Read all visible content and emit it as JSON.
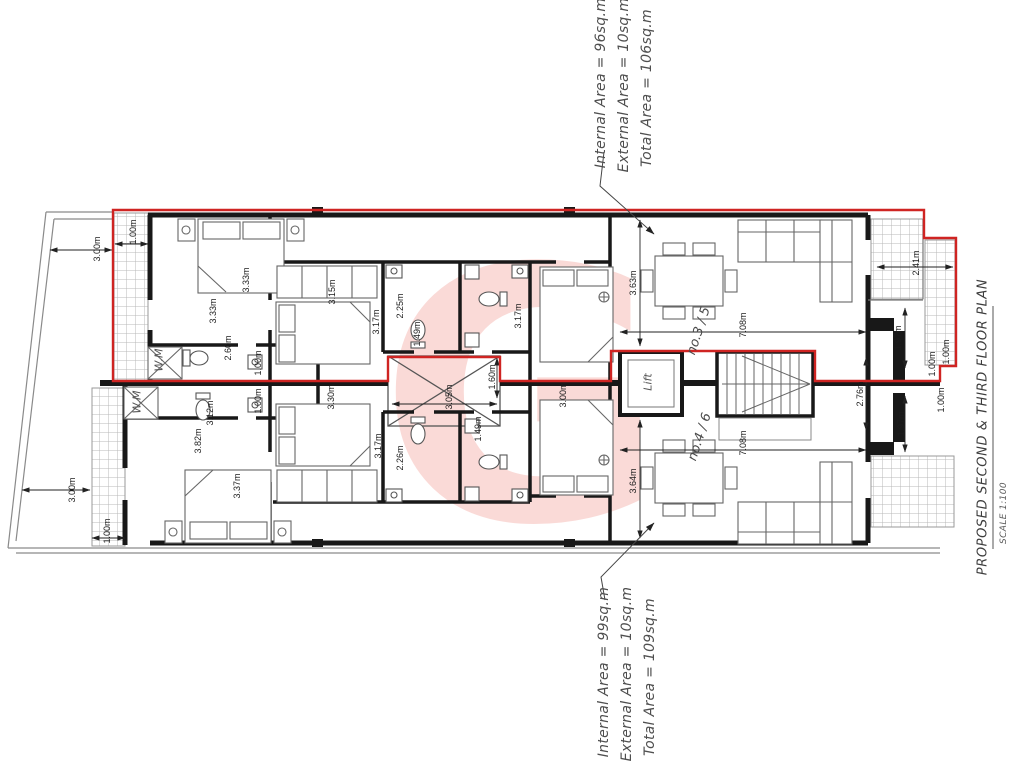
{
  "title_block": {
    "title": "PROPOSED SECOND & THIRD FLOOR PLAN",
    "scale": "SCALE 1:100"
  },
  "units": {
    "upper": {
      "unit_no": "no.3 / 5",
      "areas": [
        "Internal Area = 96sq.m",
        "External Area = 10sq.m",
        "Total Area = 106sq.m"
      ]
    },
    "lower": {
      "unit_no": "no.4 / 6",
      "areas": [
        "Internal Area = 99sq.m",
        "External Area = 10sq.m",
        "Total Area = 109sq.m"
      ]
    }
  },
  "room_labels": [
    {
      "text": "W.M",
      "x": 159,
      "y": 360
    },
    {
      "text": "W.M",
      "x": 137,
      "y": 402
    },
    {
      "text": "Lift",
      "x": 648,
      "y": 382
    }
  ],
  "dimensions": [
    {
      "text": "1.00m",
      "x": 133,
      "y": 232
    },
    {
      "text": "3.00m",
      "x": 97,
      "y": 249
    },
    {
      "text": "3.33m",
      "x": 213,
      "y": 311
    },
    {
      "text": "3.33m",
      "x": 246,
      "y": 280
    },
    {
      "text": "2.60m",
      "x": 228,
      "y": 348
    },
    {
      "text": "1.00m",
      "x": 258,
      "y": 363
    },
    {
      "text": "3.15m",
      "x": 332,
      "y": 292
    },
    {
      "text": "3.17m",
      "x": 376,
      "y": 322
    },
    {
      "text": "2.25m",
      "x": 400,
      "y": 306
    },
    {
      "text": "1.49m",
      "x": 417,
      "y": 334
    },
    {
      "text": "1.60m",
      "x": 492,
      "y": 377
    },
    {
      "text": "3.17m",
      "x": 518,
      "y": 316
    },
    {
      "text": "3.63m",
      "x": 633,
      "y": 283
    },
    {
      "text": "7.08m",
      "x": 743,
      "y": 325
    },
    {
      "text": "2.41m",
      "x": 916,
      "y": 263
    },
    {
      "text": "1.97m",
      "x": 898,
      "y": 338
    },
    {
      "text": "1.00m",
      "x": 932,
      "y": 364
    },
    {
      "text": "1.00m",
      "x": 946,
      "y": 352
    },
    {
      "text": "3.05m",
      "x": 449,
      "y": 397
    },
    {
      "text": "2.76m",
      "x": 860,
      "y": 394
    },
    {
      "text": "1.00m",
      "x": 258,
      "y": 401
    },
    {
      "text": "3.12m",
      "x": 210,
      "y": 413
    },
    {
      "text": "3.82m",
      "x": 198,
      "y": 441
    },
    {
      "text": "3.37m",
      "x": 237,
      "y": 486
    },
    {
      "text": "3.00m",
      "x": 72,
      "y": 490
    },
    {
      "text": "1.00m",
      "x": 107,
      "y": 531
    },
    {
      "text": "3.30m",
      "x": 331,
      "y": 397
    },
    {
      "text": "3.17m",
      "x": 378,
      "y": 446
    },
    {
      "text": "2.26m",
      "x": 400,
      "y": 458
    },
    {
      "text": "1.49m",
      "x": 478,
      "y": 429
    },
    {
      "text": "3.00m",
      "x": 563,
      "y": 395
    },
    {
      "text": "3.64m",
      "x": 633,
      "y": 481
    },
    {
      "text": "7.08m",
      "x": 743,
      "y": 443
    },
    {
      "text": "1.97m",
      "x": 901,
      "y": 424
    },
    {
      "text": "1.00m",
      "x": 941,
      "y": 400
    }
  ],
  "colors": {
    "outline_red": "#cf2422",
    "watermark_pink": "#e74c3c",
    "wall_black": "#181818",
    "hatch_gray": "#b9b9b9"
  }
}
